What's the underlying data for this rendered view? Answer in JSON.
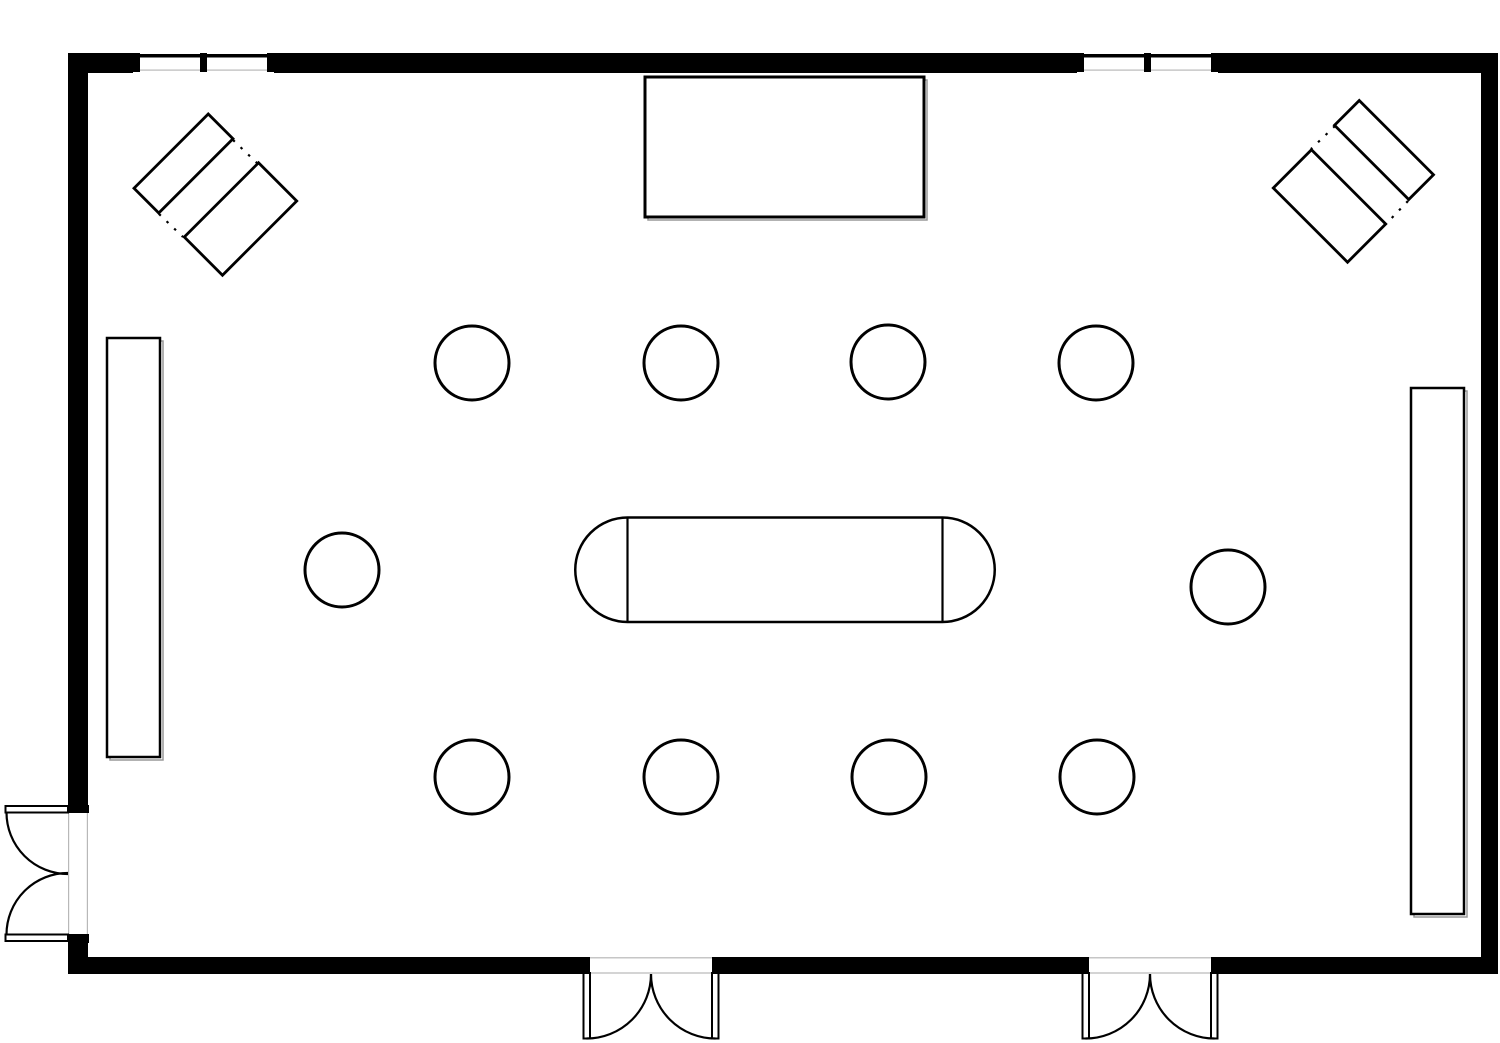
{
  "meta": {
    "description": "Black-and-white architectural floor plan of a rectangular event hall with double doors, windows, a stage, wall counters, round tables and an oval conference table",
    "colors": {
      "line": "#000000",
      "background": "#ffffff",
      "faint": "#b8b8b8",
      "shadow": "#999999"
    }
  },
  "canvas": {
    "w": 1500,
    "h": 1043,
    "background": "#ffffff"
  },
  "elements": [
    {
      "name": "wall-top-segment-1",
      "shape": "rect",
      "x": 68,
      "y": 53,
      "w": 65,
      "h": 20,
      "fill": "#000000"
    },
    {
      "name": "wall-top-segment-2",
      "shape": "rect",
      "x": 274,
      "y": 53,
      "w": 803,
      "h": 20,
      "fill": "#000000"
    },
    {
      "name": "wall-top-segment-3",
      "shape": "rect",
      "x": 1218,
      "y": 53,
      "w": 280,
      "h": 20,
      "fill": "#000000"
    },
    {
      "name": "wall-left-segment-upper",
      "shape": "rect",
      "x": 68,
      "y": 53,
      "w": 20,
      "h": 752,
      "fill": "#000000"
    },
    {
      "name": "wall-left-segment-lower",
      "shape": "rect",
      "x": 68,
      "y": 942,
      "w": 20,
      "h": 31,
      "fill": "#000000"
    },
    {
      "name": "wall-right",
      "shape": "rect",
      "x": 1481,
      "y": 53,
      "w": 17,
      "h": 921,
      "fill": "#000000"
    },
    {
      "name": "wall-bottom-segment-1",
      "shape": "rect",
      "x": 68,
      "y": 957,
      "w": 515,
      "h": 17,
      "fill": "#000000"
    },
    {
      "name": "wall-bottom-segment-2",
      "shape": "rect",
      "x": 719,
      "y": 957,
      "w": 363,
      "h": 17,
      "fill": "#000000"
    },
    {
      "name": "wall-bottom-segment-3",
      "shape": "rect",
      "x": 1218,
      "y": 957,
      "w": 280,
      "h": 17,
      "fill": "#000000"
    },
    {
      "name": "window-left-opening",
      "shape": "rect",
      "x": 133,
      "y": 53,
      "w": 141,
      "h": 20,
      "fill": "#ffffff"
    },
    {
      "name": "window-left-sill-line",
      "shape": "rect",
      "x": 140,
      "y": 69.5,
      "w": 127,
      "h": 1.2,
      "fill": "#b8b8b8"
    },
    {
      "name": "window-left-glass-line",
      "shape": "rect",
      "x": 133,
      "y": 54,
      "w": 141,
      "h": 3.5,
      "fill": "#000000"
    },
    {
      "name": "window-left-jamb-1",
      "shape": "rect",
      "x": 133,
      "y": 53,
      "w": 7,
      "h": 19,
      "fill": "#000000"
    },
    {
      "name": "window-left-jamb-2",
      "shape": "rect",
      "x": 200,
      "y": 53,
      "w": 7,
      "h": 19,
      "fill": "#000000"
    },
    {
      "name": "window-left-jamb-3",
      "shape": "rect",
      "x": 267,
      "y": 53,
      "w": 7,
      "h": 19,
      "fill": "#000000"
    },
    {
      "name": "window-right-opening",
      "shape": "rect",
      "x": 1077,
      "y": 53,
      "w": 141,
      "h": 20,
      "fill": "#ffffff"
    },
    {
      "name": "window-right-sill-line",
      "shape": "rect",
      "x": 1084,
      "y": 69.5,
      "w": 127,
      "h": 1.2,
      "fill": "#b8b8b8"
    },
    {
      "name": "window-right-glass-line",
      "shape": "rect",
      "x": 1077,
      "y": 54,
      "w": 141,
      "h": 3.5,
      "fill": "#000000"
    },
    {
      "name": "window-right-jamb-1",
      "shape": "rect",
      "x": 1077,
      "y": 53,
      "w": 7,
      "h": 19,
      "fill": "#000000"
    },
    {
      "name": "window-right-jamb-2",
      "shape": "rect",
      "x": 1144,
      "y": 53,
      "w": 7,
      "h": 19,
      "fill": "#000000"
    },
    {
      "name": "window-right-jamb-3",
      "shape": "rect",
      "x": 1211,
      "y": 53,
      "w": 7,
      "h": 19,
      "fill": "#000000"
    },
    {
      "name": "door-left-face-line-outer",
      "shape": "rect",
      "x": 68,
      "y": 813,
      "w": 1.2,
      "h": 121,
      "fill": "#b8b8b8"
    },
    {
      "name": "door-left-face-line-inner",
      "shape": "rect",
      "x": 86.8,
      "y": 813,
      "w": 1.2,
      "h": 121,
      "fill": "#b8b8b8"
    },
    {
      "name": "door-left-jamb-top",
      "shape": "rect",
      "x": 68,
      "y": 805,
      "w": 21,
      "h": 8,
      "fill": "#000000"
    },
    {
      "name": "door-left-jamb-bottom",
      "shape": "rect",
      "x": 68,
      "y": 934,
      "w": 21,
      "h": 9,
      "fill": "#000000"
    },
    {
      "name": "door-left-leaf-top",
      "shape": "rect",
      "x": 5.5,
      "y": 806,
      "w": 62.5,
      "h": 6.5,
      "fill": "#ffffff",
      "stroke": "#000000",
      "sw": 2
    },
    {
      "name": "door-left-leaf-bottom",
      "shape": "rect",
      "x": 5.5,
      "y": 934.5,
      "w": 62.5,
      "h": 6.5,
      "fill": "#ffffff",
      "stroke": "#000000",
      "sw": 2
    },
    {
      "name": "door-left-swing-arc-top",
      "shape": "path",
      "d": "M 6.5 812.5 A 61.5 61.5 0 0 0 68 874",
      "stroke": "#000000",
      "sw": 2.2
    },
    {
      "name": "door-left-swing-arc-bottom",
      "shape": "path",
      "d": "M 6.5 934.5 A 61.5 61.5 0 0 1 68 873",
      "stroke": "#000000",
      "sw": 2.2
    },
    {
      "name": "door-bottom-center-face-line-inner",
      "shape": "rect",
      "x": 590,
      "y": 957.2,
      "w": 122,
      "h": 1.2,
      "fill": "#b8b8b8"
    },
    {
      "name": "door-bottom-center-face-line-outer",
      "shape": "rect",
      "x": 590,
      "y": 972.4,
      "w": 122,
      "h": 1.2,
      "fill": "#b8b8b8"
    },
    {
      "name": "door-bottom-center-jamb-left",
      "shape": "rect",
      "x": 583,
      "y": 957,
      "w": 7,
      "h": 17,
      "fill": "#000000"
    },
    {
      "name": "door-bottom-center-jamb-right",
      "shape": "rect",
      "x": 712,
      "y": 957,
      "w": 7,
      "h": 17,
      "fill": "#000000"
    },
    {
      "name": "door-bottom-center-leaf-left",
      "shape": "rect",
      "x": 583.5,
      "y": 973,
      "w": 6.5,
      "h": 65.5,
      "fill": "#ffffff",
      "stroke": "#000000",
      "sw": 2
    },
    {
      "name": "door-bottom-center-leaf-right",
      "shape": "rect",
      "x": 712,
      "y": 973,
      "w": 6.5,
      "h": 65.5,
      "fill": "#ffffff",
      "stroke": "#000000",
      "sw": 2
    },
    {
      "name": "door-bottom-center-swing-arc-left",
      "shape": "path",
      "d": "M 651 974 A 64.5 64.5 0 0 1 586.5 1038.5",
      "stroke": "#000000",
      "sw": 2.2
    },
    {
      "name": "door-bottom-center-swing-arc-right",
      "shape": "path",
      "d": "M 651 974 A 64.5 64.5 0 0 0 715.5 1038.5",
      "stroke": "#000000",
      "sw": 2.2
    },
    {
      "name": "door-bottom-right-face-line-inner",
      "shape": "rect",
      "x": 1089,
      "y": 957.2,
      "w": 122,
      "h": 1.2,
      "fill": "#b8b8b8"
    },
    {
      "name": "door-bottom-right-face-line-outer",
      "shape": "rect",
      "x": 1089,
      "y": 972.4,
      "w": 122,
      "h": 1.2,
      "fill": "#b8b8b8"
    },
    {
      "name": "door-bottom-right-jamb-left",
      "shape": "rect",
      "x": 1082,
      "y": 957,
      "w": 7,
      "h": 17,
      "fill": "#000000"
    },
    {
      "name": "door-bottom-right-jamb-right",
      "shape": "rect",
      "x": 1211,
      "y": 957,
      "w": 7,
      "h": 17,
      "fill": "#000000"
    },
    {
      "name": "door-bottom-right-leaf-left",
      "shape": "rect",
      "x": 1082.5,
      "y": 973,
      "w": 6.5,
      "h": 65.5,
      "fill": "#ffffff",
      "stroke": "#000000",
      "sw": 2
    },
    {
      "name": "door-bottom-right-leaf-right",
      "shape": "rect",
      "x": 1211,
      "y": 973,
      "w": 6.5,
      "h": 65.5,
      "fill": "#ffffff",
      "stroke": "#000000",
      "sw": 2
    },
    {
      "name": "door-bottom-right-swing-arc-left",
      "shape": "path",
      "d": "M 1150 974 A 64.5 64.5 0 0 1 1085.5 1038.5",
      "stroke": "#000000",
      "sw": 2.2
    },
    {
      "name": "door-bottom-right-swing-arc-right",
      "shape": "path",
      "d": "M 1150 974 A 64.5 64.5 0 0 0 1214.5 1038.5",
      "stroke": "#000000",
      "sw": 2.2
    },
    {
      "name": "stage-shadow",
      "shape": "rect",
      "x": 648,
      "y": 80,
      "w": 279,
      "h": 140,
      "stroke": "#999999",
      "sw": 1.5
    },
    {
      "name": "stage",
      "shape": "rect",
      "x": 645,
      "y": 77,
      "w": 279,
      "h": 140,
      "fill": "#ffffff",
      "stroke": "#000000",
      "sw": 3
    },
    {
      "name": "counter-left-shadow",
      "shape": "rect",
      "x": 110,
      "y": 341,
      "w": 53,
      "h": 419,
      "stroke": "#999999",
      "sw": 1.5
    },
    {
      "name": "counter-left",
      "shape": "rect",
      "x": 107,
      "y": 338,
      "w": 53,
      "h": 419,
      "fill": "#ffffff",
      "stroke": "#000000",
      "sw": 2.5
    },
    {
      "name": "counter-right-shadow",
      "shape": "rect",
      "x": 1414,
      "y": 391,
      "w": 53,
      "h": 526,
      "stroke": "#999999",
      "sw": 1.5
    },
    {
      "name": "counter-right",
      "shape": "rect",
      "x": 1411,
      "y": 388,
      "w": 53,
      "h": 526,
      "fill": "#ffffff",
      "stroke": "#000000",
      "sw": 2.5
    },
    {
      "name": "corner-table-top-left-narrow",
      "shape": "rect",
      "x": 131,
      "y": 146,
      "w": 105,
      "h": 35,
      "rotate": [
        -45,
        183.5,
        163.5
      ],
      "fill": "#ffffff",
      "stroke": "#000000",
      "sw": 2.8
    },
    {
      "name": "corner-table-top-left-wide",
      "shape": "rect",
      "x": 188,
      "y": 192,
      "w": 105,
      "h": 54,
      "rotate": [
        -45,
        240.5,
        219
      ],
      "fill": "#ffffff",
      "stroke": "#000000",
      "sw": 2.8
    },
    {
      "name": "corner-top-left-dotted-link-1",
      "shape": "line",
      "x1": 233,
      "y1": 140,
      "x2": 257,
      "y2": 163,
      "stroke": "#000000",
      "sw": 2.2,
      "dash": "2.5 8"
    },
    {
      "name": "corner-top-left-dotted-link-2",
      "shape": "line",
      "x1": 159,
      "y1": 214,
      "x2": 183,
      "y2": 237,
      "stroke": "#000000",
      "sw": 2.2,
      "dash": "2.5 8"
    },
    {
      "name": "corner-table-top-right-narrow",
      "shape": "rect",
      "x": 1331.5,
      "y": 132.5,
      "w": 105,
      "h": 35,
      "rotate": [
        45,
        1384,
        150
      ],
      "fill": "#ffffff",
      "stroke": "#000000",
      "sw": 2.8
    },
    {
      "name": "corner-table-top-right-wide",
      "shape": "rect",
      "x": 1277,
      "y": 179,
      "w": 105,
      "h": 54,
      "rotate": [
        45,
        1329.5,
        206
      ],
      "fill": "#ffffff",
      "stroke": "#000000",
      "sw": 2.8
    },
    {
      "name": "corner-top-right-dotted-link-1",
      "shape": "line",
      "x1": 1335,
      "y1": 126,
      "x2": 1311,
      "y2": 149,
      "stroke": "#000000",
      "sw": 2.2,
      "dash": "2.5 8"
    },
    {
      "name": "corner-top-right-dotted-link-2",
      "shape": "line",
      "x1": 1408,
      "y1": 201,
      "x2": 1386,
      "y2": 224,
      "stroke": "#000000",
      "sw": 2.2,
      "dash": "2.5 8"
    },
    {
      "name": "conference-table",
      "shape": "path",
      "d": "M 627.5 517.5 L 942.5 517.5 A 52.25 52.25 0 0 1 942.5 622 L 627.5 622 A 52.25 52.25 0 0 1 627.5 517.5 Z",
      "fill": "#ffffff",
      "stroke": "#000000",
      "sw": 2.5
    },
    {
      "name": "conference-table-divider-left",
      "shape": "line",
      "x1": 627.5,
      "y1": 517.5,
      "x2": 627.5,
      "y2": 622,
      "stroke": "#000000",
      "sw": 2.2
    },
    {
      "name": "conference-table-divider-right",
      "shape": "line",
      "x1": 942.5,
      "y1": 517.5,
      "x2": 942.5,
      "y2": 622,
      "stroke": "#000000",
      "sw": 2.2
    },
    {
      "name": "round-table-top-1",
      "shape": "circle",
      "cx": 472,
      "cy": 363,
      "r": 37,
      "fill": "#ffffff",
      "stroke": "#000000",
      "sw": 3
    },
    {
      "name": "round-table-top-2",
      "shape": "circle",
      "cx": 681,
      "cy": 363,
      "r": 37,
      "fill": "#ffffff",
      "stroke": "#000000",
      "sw": 3
    },
    {
      "name": "round-table-top-3",
      "shape": "circle",
      "cx": 888,
      "cy": 362,
      "r": 37,
      "fill": "#ffffff",
      "stroke": "#000000",
      "sw": 3
    },
    {
      "name": "round-table-top-4",
      "shape": "circle",
      "cx": 1096,
      "cy": 363,
      "r": 37,
      "fill": "#ffffff",
      "stroke": "#000000",
      "sw": 3
    },
    {
      "name": "round-table-middle-left",
      "shape": "circle",
      "cx": 342,
      "cy": 570,
      "r": 37,
      "fill": "#ffffff",
      "stroke": "#000000",
      "sw": 3
    },
    {
      "name": "round-table-middle-right",
      "shape": "circle",
      "cx": 1228,
      "cy": 587,
      "r": 37,
      "fill": "#ffffff",
      "stroke": "#000000",
      "sw": 3
    },
    {
      "name": "round-table-bottom-1",
      "shape": "circle",
      "cx": 472,
      "cy": 777,
      "r": 37,
      "fill": "#ffffff",
      "stroke": "#000000",
      "sw": 3
    },
    {
      "name": "round-table-bottom-2",
      "shape": "circle",
      "cx": 681,
      "cy": 777,
      "r": 37,
      "fill": "#ffffff",
      "stroke": "#000000",
      "sw": 3
    },
    {
      "name": "round-table-bottom-3",
      "shape": "circle",
      "cx": 889,
      "cy": 777,
      "r": 37,
      "fill": "#ffffff",
      "stroke": "#000000",
      "sw": 3
    },
    {
      "name": "round-table-bottom-4",
      "shape": "circle",
      "cx": 1097,
      "cy": 777,
      "r": 37,
      "fill": "#ffffff",
      "stroke": "#000000",
      "sw": 3
    }
  ]
}
